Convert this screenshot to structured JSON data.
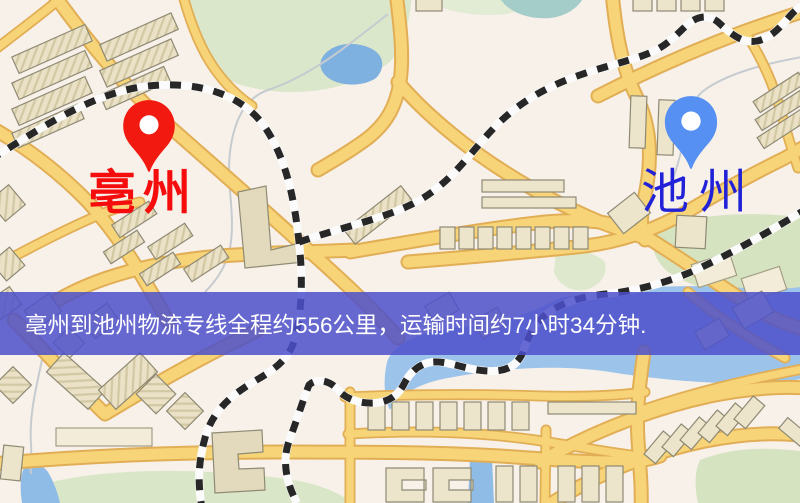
{
  "map": {
    "origin": {
      "label": "亳州",
      "pin_icon": "red-location-pin-icon",
      "pin_color": "#f21a10",
      "label_color": "#f50d0d"
    },
    "destination": {
      "label": "池州",
      "pin_icon": "blue-location-pin-icon",
      "pin_color": "#5590f2",
      "label_color": "#2121d8"
    },
    "palette": {
      "background": "#f7f1ea",
      "road_fill": "#f6d477",
      "road_border": "#e2ae55",
      "building": "#ece4cb",
      "park_green": "#d8e5c4",
      "water_blue": "#8fbfe8",
      "railway_dark": "#272727"
    }
  },
  "banner": {
    "text": "亳州到池州物流专线全程约556公里，运输时间约7小时34分钟.",
    "background": "#4c50ca",
    "text_color": "#ffffff"
  }
}
